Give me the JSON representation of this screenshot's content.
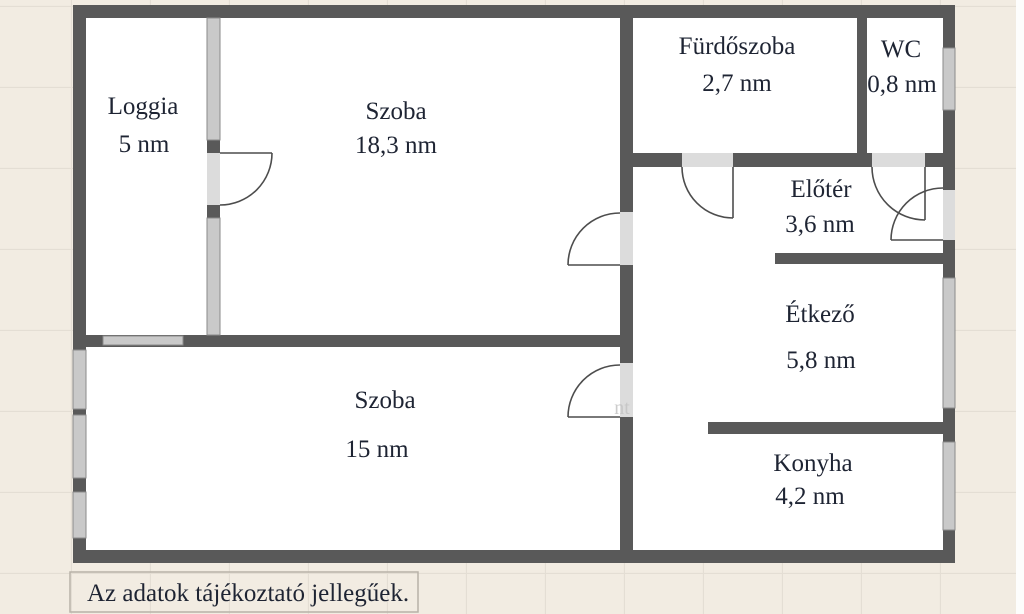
{
  "rooms": {
    "loggia": {
      "name": "Loggia",
      "area": "5 nm"
    },
    "szoba1": {
      "name": "Szoba",
      "area": "18,3 nm"
    },
    "furdoszoba": {
      "name": "Fürdőszoba",
      "area": "2,7 nm"
    },
    "wc": {
      "name": "WC",
      "area": "0,8 nm"
    },
    "eloter": {
      "name": "Előtér",
      "area": "3,6 nm"
    },
    "etkezo": {
      "name": "Étkező",
      "area": "5,8 nm"
    },
    "szoba2": {
      "name": "Szoba",
      "area": "15 nm"
    },
    "konyha": {
      "name": "Konyha",
      "area": "4,2 nm"
    }
  },
  "disclaimer": "Az adatok tájékoztató jellegűek.",
  "watermark": "nt",
  "colors": {
    "background": "#f2ece2",
    "grid_line": "#e4ded4",
    "floor": "#ffffff",
    "wall": "#595959",
    "window": "#c9c9c9",
    "door_opening": "#dcdcdc",
    "door_arc": "#4d4d4d",
    "text": "#1e2433"
  }
}
